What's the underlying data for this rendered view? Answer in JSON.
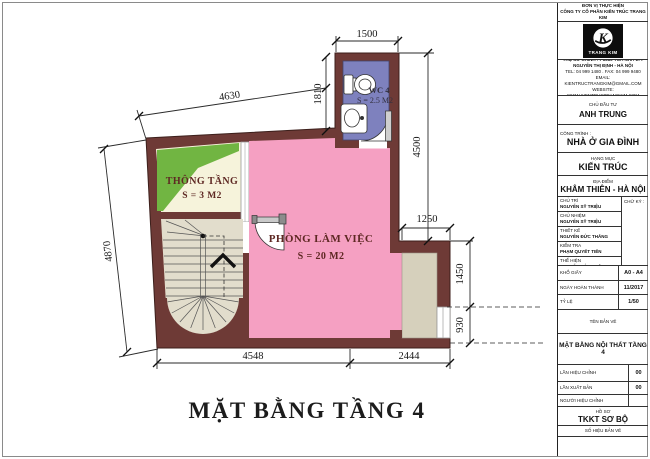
{
  "sheet": {
    "title": "MẶT BẰNG TẦNG 4"
  },
  "rooms": {
    "void": {
      "name": "THÔNG TẦNG",
      "area": "S = 3 M2"
    },
    "office": {
      "name": "PHÒNG LÀM VIỆC",
      "area": "S = 20 M2"
    },
    "wc": {
      "name": "WC 4",
      "area": "S = 2.5 M2"
    }
  },
  "dimensions": {
    "wc_width": "1500",
    "wc_height": "1810",
    "top": "4630",
    "right_upper": "4500",
    "step": "1250",
    "right_mid": "1450",
    "right_lower": "930",
    "left": "4870",
    "bottom_left": "4548",
    "bottom_right": "2444"
  },
  "colors": {
    "wall": "#6E3A36",
    "office_pink": "#F5A0C2",
    "wc_purple": "#7E81BE",
    "void_green": "#71B542",
    "void_cream": "#F6F3DB",
    "stair_beige": "#E2DDCC",
    "alcove_beige": "#D6D0BC"
  },
  "titleblock": {
    "unit_label": "ĐƠN VỊ THỰC HIỆN",
    "unit_name": "CÔNG TY CỔ PHẦN KIẾN TRÚC TRANG KIM",
    "logo_text": "TRANG KIM",
    "address": [
      "TRỤ SỞ CHÍNH : P1610 TÒA NHÀ 17T",
      "NGUYỄN THỊ ĐỊNH - HÀ NỘI",
      "TEL: 04 999 1480 . FAX: 04 999 9480",
      "EMAIL: KIENTRUCTRANGKIM@GMAIL.COM",
      "WEBSITE: WWW.KIENTRUCTRANGKIM.COM"
    ],
    "investor_label": "CHỦ ĐẦU TƯ",
    "investor": "ANH TRUNG",
    "project_label": "CÔNG TRÌNH :",
    "project": "NHÀ Ở GIA ĐÌNH",
    "category_label": "HẠNG MỤC",
    "category": "KIẾN TRÚC",
    "location_label": "ĐỊA ĐIỂM",
    "location": "KHÂM THIÊN - HÀ NỘI",
    "signature_label": "CHỮ KÝ :",
    "personnel": [
      {
        "role": "CHỦ TRÌ",
        "name": "NGUYỄN SỸ TRIỆU"
      },
      {
        "role": "CHỦ NHIỆM",
        "name": "NGUYỄN SỸ TRIỆU"
      },
      {
        "role": "THIẾT KẾ",
        "name": "NGUYỄN ĐỨC THẮNG"
      },
      {
        "role": "KIỂM TRA",
        "name": "PHẠM QUYẾT TIẾN"
      },
      {
        "role": "THỂ HIỆN",
        "name": "NGUYỄN ĐỨC THẮNG"
      }
    ],
    "paper_label": "KHỔ GIẤY",
    "paper": "A0 - A4",
    "date_label": "NGÀY HOÀN THÀNH",
    "date": "11/2017",
    "scale_label": "TỶ LỆ",
    "scale": "1/50",
    "drawing_name_label": "TÊN BẢN VẼ",
    "drawing_name": "MẶT BẰNG NỘI THẤT TẦNG 4",
    "revision_label": "LẦN HIỆU CHỈNH",
    "revision": "00",
    "edition_label": "LẦN XUẤT BẢN",
    "edition": "00",
    "reviser_label": "NGƯỜI HIỆU CHỈNH",
    "dossier_label": "HỒ SƠ",
    "dossier": "TKKT SƠ BỘ",
    "number_label": "SỐ HIỆU BẢN VẼ"
  }
}
